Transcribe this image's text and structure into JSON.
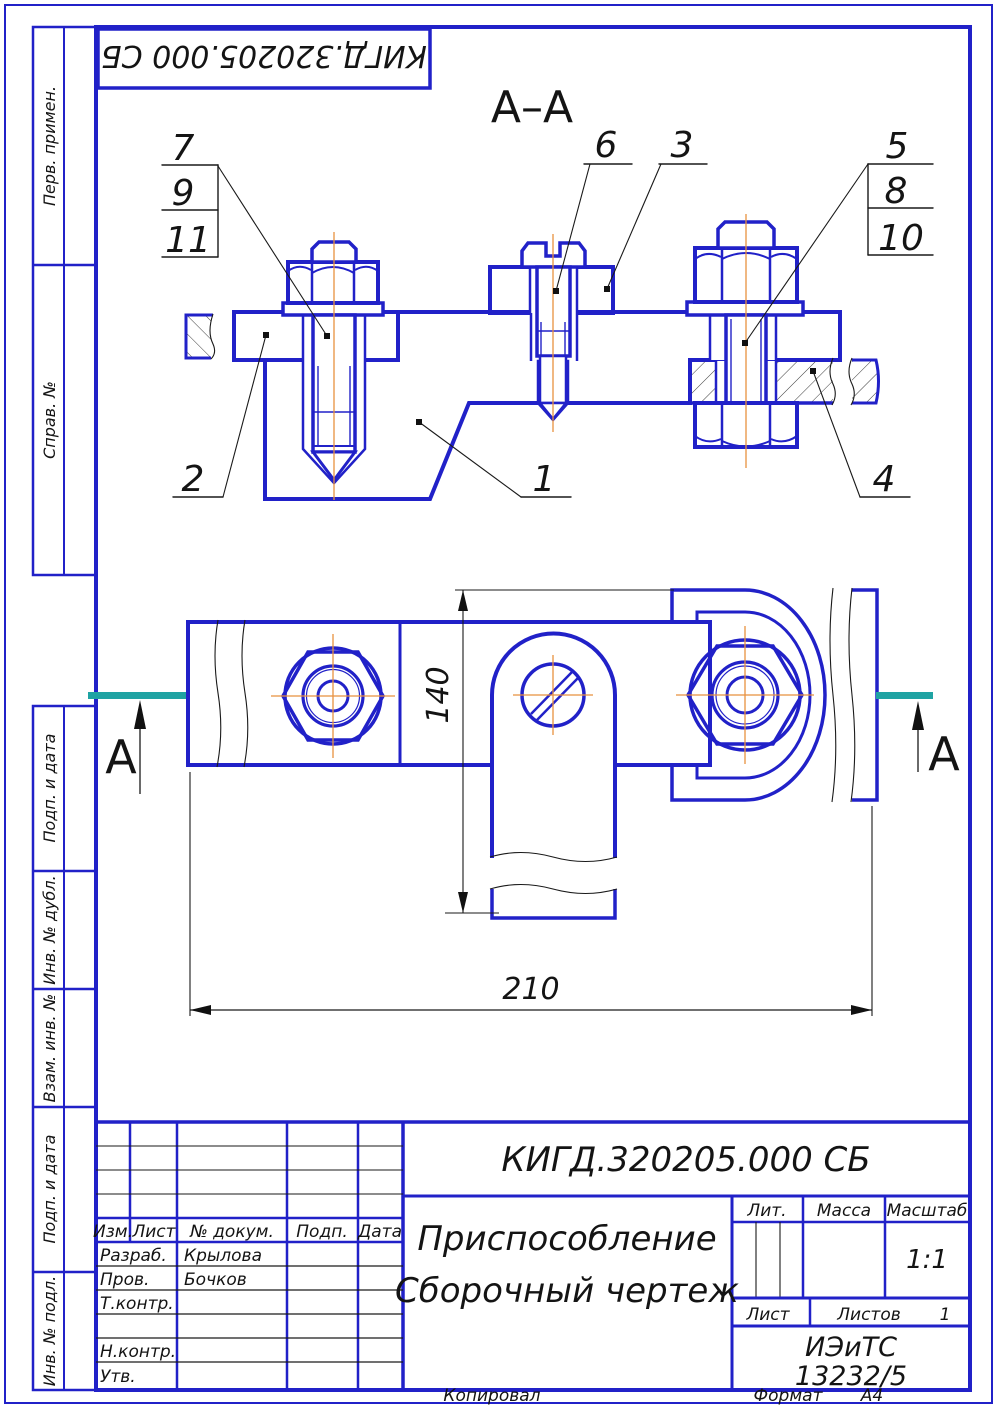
{
  "colors": {
    "blue": "#2121c8",
    "orange": "#e8913f",
    "teal": "#1fa3a3",
    "ink": "#141414"
  },
  "stamp": {
    "designation": "КИГД.320205.000 СБ"
  },
  "drawing": {
    "section_title": "А–А",
    "section_letter": "А",
    "dim_vertical": "140",
    "dim_horizontal": "210",
    "callouts": {
      "n1": "1",
      "n2": "2",
      "n3": "3",
      "n4": "4",
      "n5": "5",
      "n6": "6",
      "n7": "7",
      "n8": "8",
      "n9": "9",
      "n10": "10",
      "n11": "11"
    }
  },
  "left_margin": {
    "cells": [
      {
        "label": "Перв. примен."
      },
      {
        "label": "Справ. №"
      },
      {
        "label": "Подп. и дата"
      },
      {
        "label": "Инв. № дубл."
      },
      {
        "label": "Взам. инв. №"
      },
      {
        "label": "Подп. и дата"
      },
      {
        "label": "Инв. № подл."
      }
    ]
  },
  "title_block": {
    "designation": "КИГД.320205.000 СБ",
    "name_line1": "Приспособление",
    "name_line2": "Сборочный чертеж",
    "lit_label": "Лит.",
    "mass_label": "Масса",
    "scale_label": "Масштаб",
    "scale_value": "1:1",
    "sheet_label": "Лист",
    "sheets_label": "Листов",
    "sheets_value": "1",
    "org_line1": "ИЭиТС",
    "org_line2": "13232/5",
    "columns": {
      "izm": "Изм.",
      "sheet": "Лист",
      "doc": "№ докум.",
      "sign": "Подп.",
      "date": "Дата"
    },
    "rows": [
      {
        "role": "Разраб.",
        "name": "Крылова"
      },
      {
        "role": "Пров.",
        "name": "Бочков"
      },
      {
        "role": "Т.контр.",
        "name": ""
      },
      {
        "role": "Н.контр.",
        "name": ""
      },
      {
        "role": "Утв.",
        "name": ""
      }
    ],
    "footer": {
      "copied": "Копировал",
      "format_label": "Формат",
      "format_value": "А4"
    }
  }
}
